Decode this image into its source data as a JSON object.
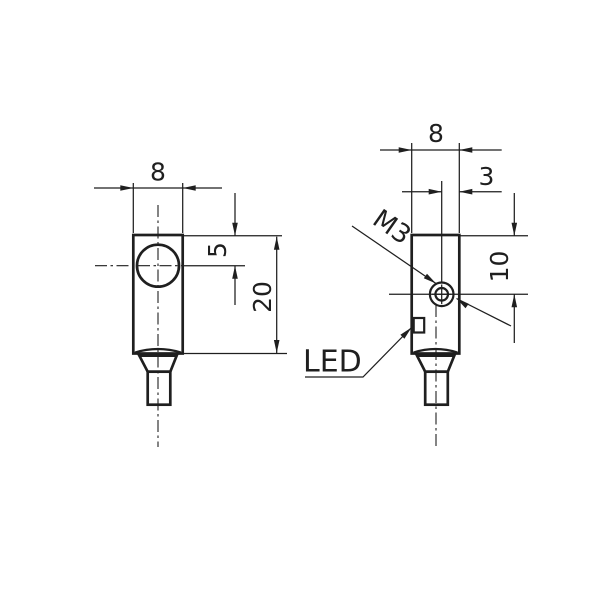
{
  "drawing": {
    "type": "technical-dimension-drawing",
    "colors": {
      "background": "#ffffff",
      "line": "#1f1f1f"
    },
    "front_view": {
      "width_dim": "8",
      "face_center_dim": "5",
      "body_length_dim": "20"
    },
    "side_view": {
      "width_dim": "8",
      "screw_offset_dim": "3",
      "screw_center_dim": "10",
      "thread_label": "M3",
      "led_label": "LED"
    }
  }
}
